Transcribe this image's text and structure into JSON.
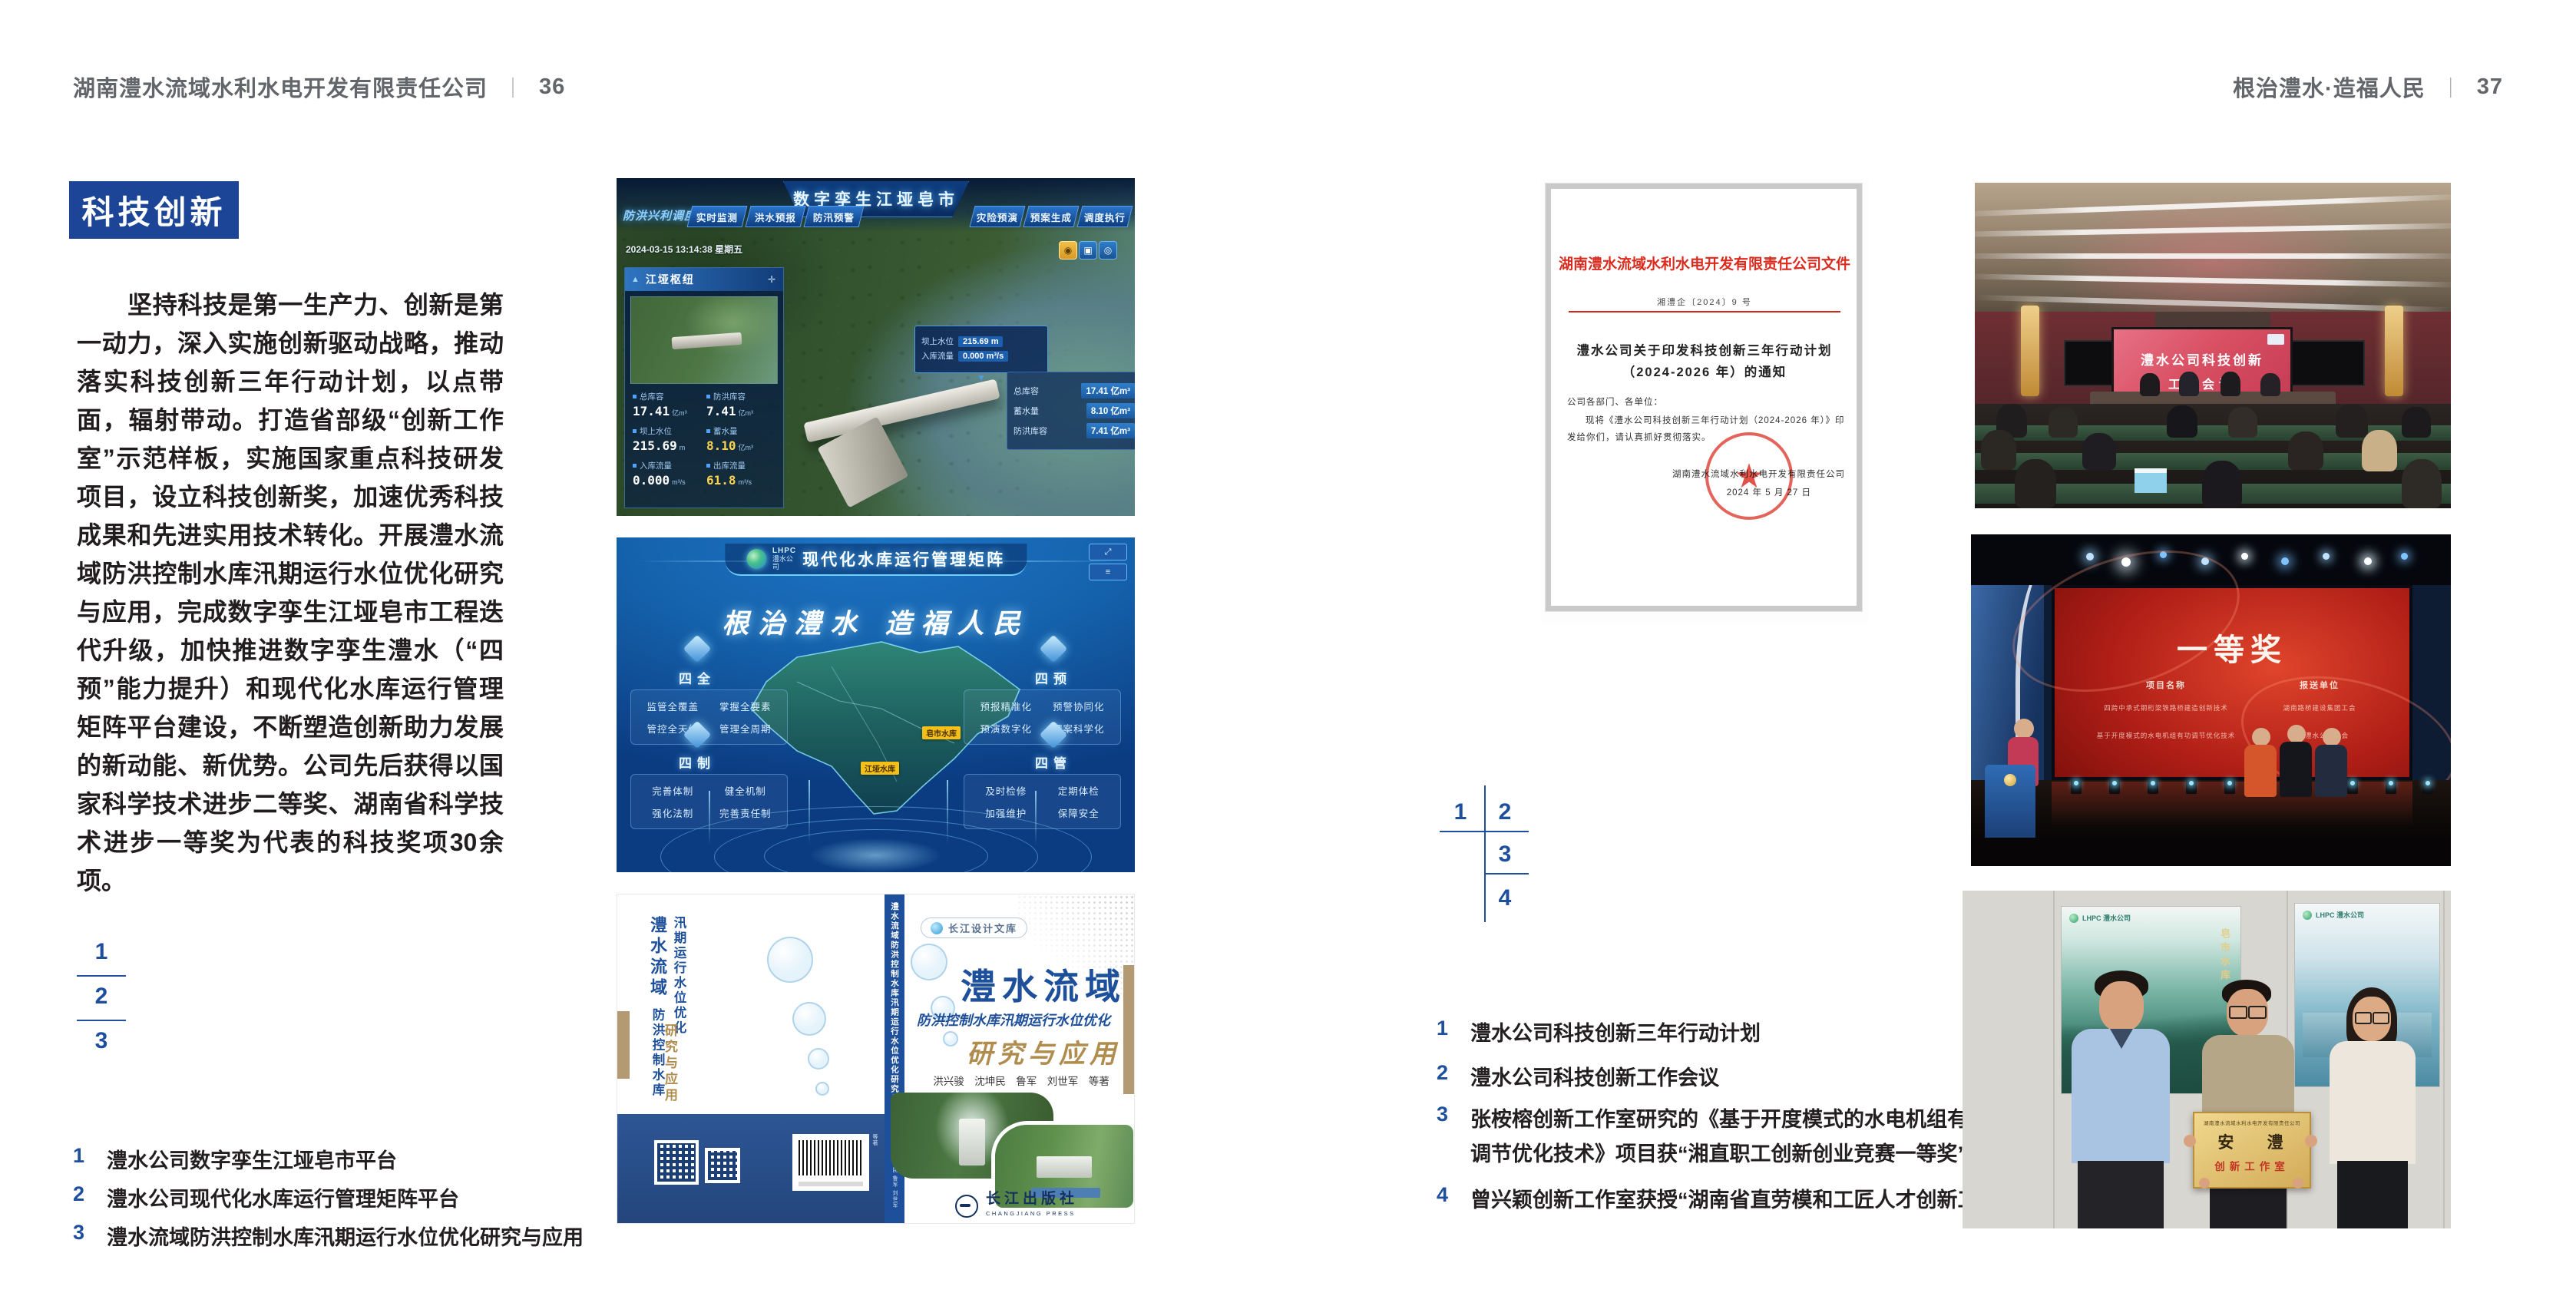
{
  "colors": {
    "accent_blue": "#1c4598",
    "index_blue": "#1e4f9e",
    "doc_red": "#d7281c",
    "book_blue": "#1d4f9a",
    "book_tan": "#b08c4e"
  },
  "icons": {
    "move": "✛",
    "pyramid": "▲",
    "caret_down": "▼",
    "user": "◉",
    "layers": "▣",
    "locate": "◎",
    "fullscreen": "⤢",
    "expand": "⤢",
    "menu": "≡",
    "star": "★"
  },
  "left_page": {
    "header": {
      "company": "湖南澧水流域水利水电开发有限责任公司",
      "divider": "｜",
      "page": "36"
    },
    "badge": "科技创新",
    "body": "坚持科技是第一生产力、创新是第一动力，深入实施创新驱动战略，推动落实科技创新三年行动计划，以点带面，辐射带动。打造省部级“创新工作室”示范样板，实施国家重点科技研发项目，设立科技创新奖，加速优秀科技成果和先进实用技术转化。开展澧水流域防洪控制水库汛期运行水位优化研究与应用，完成数字孪生江垭皂市工程迭代升级，加快推进数字孪生澧水（“四预”能力提升）和现代化水库运行管理矩阵平台建设，不断塑造创新助力发展的新动能、新优势。公司先后获得以国家科学技术进步二等奖、湖南省科学技术进步一等奖为代表的科技奖项30余项。",
    "figure_numbers": [
      "1",
      "2",
      "3"
    ],
    "captions": [
      {
        "n": "1",
        "t": "澧水公司数字孪生江垭皂市平台"
      },
      {
        "n": "2",
        "t": "澧水公司现代化水库运行管理矩阵平台"
      },
      {
        "n": "3",
        "t": "澧水流域防洪控制水库汛期运行水位优化研究与应用"
      }
    ]
  },
  "right_page": {
    "header": {
      "slogan": "根治澧水·造福人民",
      "divider": "｜",
      "page": "37"
    },
    "figure_numbers": [
      "1",
      "2",
      "3",
      "4"
    ],
    "captions": [
      {
        "n": "1",
        "t": "澧水公司科技创新三年行动计划"
      },
      {
        "n": "2",
        "t": "澧水公司科技创新工作会议"
      },
      {
        "n": "3",
        "t": "张桉榕创新工作室研究的《基于开度模式的水电机组有功调节优化技术》项目获“湘直职工创新创业竞赛一等奖”"
      },
      {
        "n": "4",
        "t": "曾兴颖创新工作室获授“湖南省直劳模和工匠人才创新工作室”"
      }
    ]
  },
  "dashboard": {
    "corner_label": "防洪兴利调度",
    "title": "数字孪生江垭皂市",
    "tabs_left": [
      "实时监测",
      "洪水预报",
      "防汛预警"
    ],
    "tabs_right": [
      "灾险预演",
      "预案生成",
      "调度执行",
      "工程导览"
    ],
    "timestamp": "2024-03-15 13:14:38 星期五",
    "panel_title": "江垭枢纽",
    "stats": [
      {
        "label": "总库容",
        "value": "17.41",
        "unit": "亿m³"
      },
      {
        "label": "防洪库容",
        "value": "7.41",
        "unit": "亿m³"
      },
      {
        "label": "坝上水位",
        "value": "215.69",
        "unit": "m"
      },
      {
        "label": "蓄水量",
        "value": "8.10",
        "unit": "亿m³"
      },
      {
        "label": "入库流量",
        "value": "0.000",
        "unit": "m³/s"
      },
      {
        "label": "出库流量",
        "value": "61.8",
        "unit": "m³/s"
      }
    ],
    "tooltip": [
      {
        "label": "坝上水位",
        "value": "215.69 m"
      },
      {
        "label": "入库流量",
        "value": "0.000 m³/s"
      }
    ],
    "side_panel": [
      {
        "label": "总库容",
        "value": "17.41 亿m³"
      },
      {
        "label": "蓄水量",
        "value": "8.10 亿m³"
      },
      {
        "label": "防洪库容",
        "value": "7.41 亿m³"
      }
    ]
  },
  "matrix": {
    "logo_line1": "LHPC",
    "logo_line2": "澧水公司",
    "title": "现代化水库运行管理矩阵",
    "slogan": "根治澧水 造福人民",
    "map_labels": [
      "江垭水库",
      "皂市水库"
    ],
    "quadrants": [
      {
        "name": "四全",
        "items": [
          "监管全覆盖",
          "掌握全要素",
          "管控全天候",
          "管理全周期"
        ]
      },
      {
        "name": "四预",
        "items": [
          "预报精准化",
          "预警协同化",
          "预演数字化",
          "预案科学化"
        ]
      },
      {
        "name": "四制",
        "items": [
          "完善体制",
          "健全机制",
          "强化法制",
          "完善责任制"
        ]
      },
      {
        "name": "四管",
        "items": [
          "及时检修",
          "定期体检",
          "加强维护",
          "保障安全"
        ]
      }
    ]
  },
  "book": {
    "series": "长江设计文库",
    "back_title_1": "澧水流域",
    "back_title_2": "防洪控制水库汛期运行水位优化",
    "back_title_3": "研究与应用",
    "spine_text": "澧水流域防洪控制水库汛期运行水位优化研究与应用",
    "spine_authors": "洪兴骏 沈坤民 鲁军 刘世军 等著",
    "title_1": "澧水流域",
    "title_2": "防洪控制水库汛期运行水位优化",
    "title_3": "研究与应用",
    "authors": "洪兴骏　沈坤民　鲁军　刘世军　等著",
    "publisher": "长江出版社",
    "publisher_en": "CHANGJIANG PRESS"
  },
  "document": {
    "header": "湖南澧水流域水利水电开发有限责任公司文件",
    "doc_number": "湘澧企〔2024〕9 号",
    "title_1": "澧水公司关于印发科技创新三年行动计划",
    "title_2": "（2024-2026 年）的通知",
    "salutation": "公司各部门、各单位：",
    "body_1": "现将《澧水公司科技创新三年行动计划（2024-2026 年）》印",
    "body_2": "发给你们，请认真抓好贯彻落实。",
    "signature": "湖南澧水流域水利水电开发有限责任公司",
    "date": "2024 年 5 月 27 日"
  },
  "meeting": {
    "screen_1": "澧水公司科技创新",
    "screen_2": "工作会议"
  },
  "stage": {
    "award": "一等奖",
    "col_1_header": "项目名称",
    "col_2_header": "报送单位",
    "rows": [
      {
        "project": "四跨中承式钢桁梁铁路桥建造创新技术",
        "unit": "湖南路桥建设集团工会"
      },
      {
        "project": "基于开度模式的水电机组有功调节优化技术",
        "unit": "湖南澧水公司工会"
      }
    ]
  },
  "group": {
    "plaque_header": "湖南澧水流域水利水电开发有限责任公司",
    "plaque_title": "安 澧",
    "plaque_subtitle": "创新工作室",
    "poster_logo_1": "LHPC 澧水公司",
    "poster_logo_2": "LHPC 澧水公司",
    "poster_caption": "皂市水库"
  }
}
